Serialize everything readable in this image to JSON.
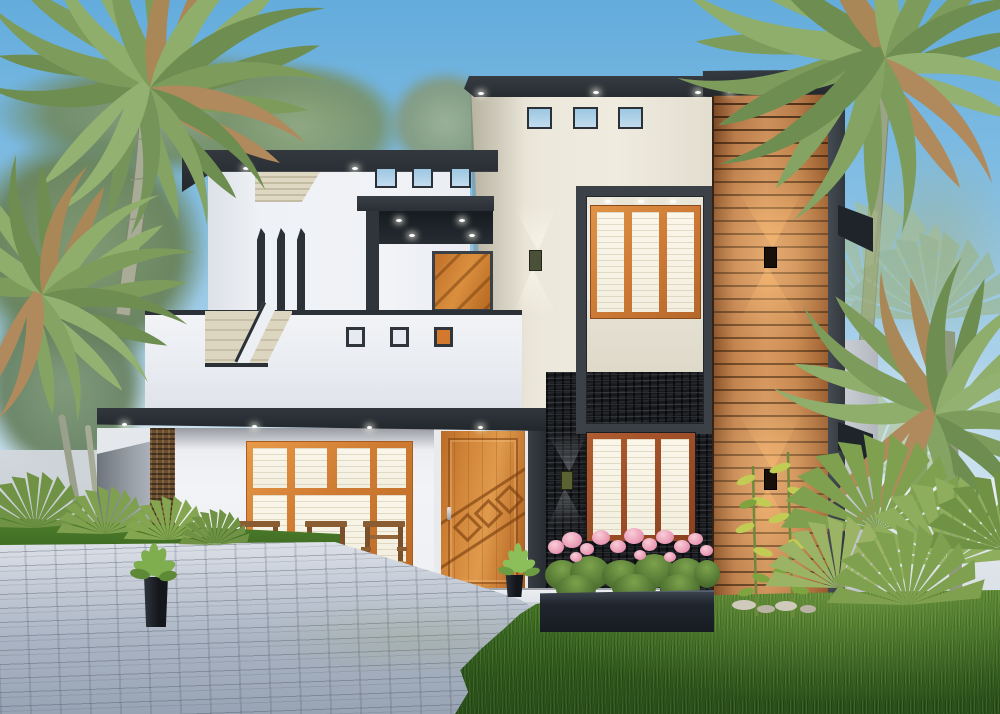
{
  "scene": {
    "type": "architectural-exterior-render",
    "description": "Modern two-storey tropical house with charcoal accents, wood-slat feature tower, black stone cladding, orange-framed windows, lawn and paved driveway flanked by palm trees",
    "palette": {
      "sky_top": "#63acdc",
      "sky_horizon": "#e0ecf3",
      "charcoal": "#2e343a",
      "charcoal_dark": "#1f242a",
      "wall_white": "#eef0f4",
      "wall_shadow": "#d8dde6",
      "tower_cream": "#e9e5d8",
      "louver_beige": "#d9d3bd",
      "wood_slat": "#b97a4b",
      "wood_glow": "#ffc482",
      "window_frame_orange": "#d07c33",
      "window_frame_maroon": "#9d4e27",
      "window_pane": "#f7f3e6",
      "sky_glass": "#9cc7e2",
      "door_wood": "#c87a35",
      "stone_black": "#16181c",
      "stone_pillar": "#6b4e2f",
      "lawn_green": "#3a6822",
      "paver_gray": "#aab4c3",
      "flower_pink": "#eca0b9",
      "palm_green": "#7d9c5c",
      "palm_dry": "#b08a5c",
      "trunk_gray": "#a8ac96",
      "planter_black": "#20262e"
    },
    "house": {
      "left_block": {
        "small_windows": 3,
        "louver_vent": 1,
        "balcony_posts": 3,
        "parapet_openings": 3,
        "upper_door": 1,
        "canopy_downlights": 4,
        "staircase": true
      },
      "central_tower": {
        "top_windows": 3,
        "bay_window_panes": 3,
        "bay_downlights": 3,
        "wall_sconces": 1,
        "roof_downlights": 3
      },
      "ground_floor": {
        "main_door": 1,
        "door_diamonds": 3,
        "big_window_top_panes": 4,
        "big_window_bottom_panes": 3,
        "porch_chairs": 3,
        "stone_wall_window_panes": 3,
        "fascia_downlights": 4
      },
      "wood_tower": {
        "wall_sconces": 2,
        "side_fins": 2,
        "slat_direction": "horizontal"
      }
    },
    "landscape": {
      "palm_crowns_left": 2,
      "palm_crowns_right": 2,
      "fan_shrubs": 9,
      "flower_bed_color": "pink",
      "black_planters": 3,
      "tall_stalk_plants": 2,
      "lawn": true,
      "paved_driveway": true,
      "grass_strip": true
    }
  }
}
